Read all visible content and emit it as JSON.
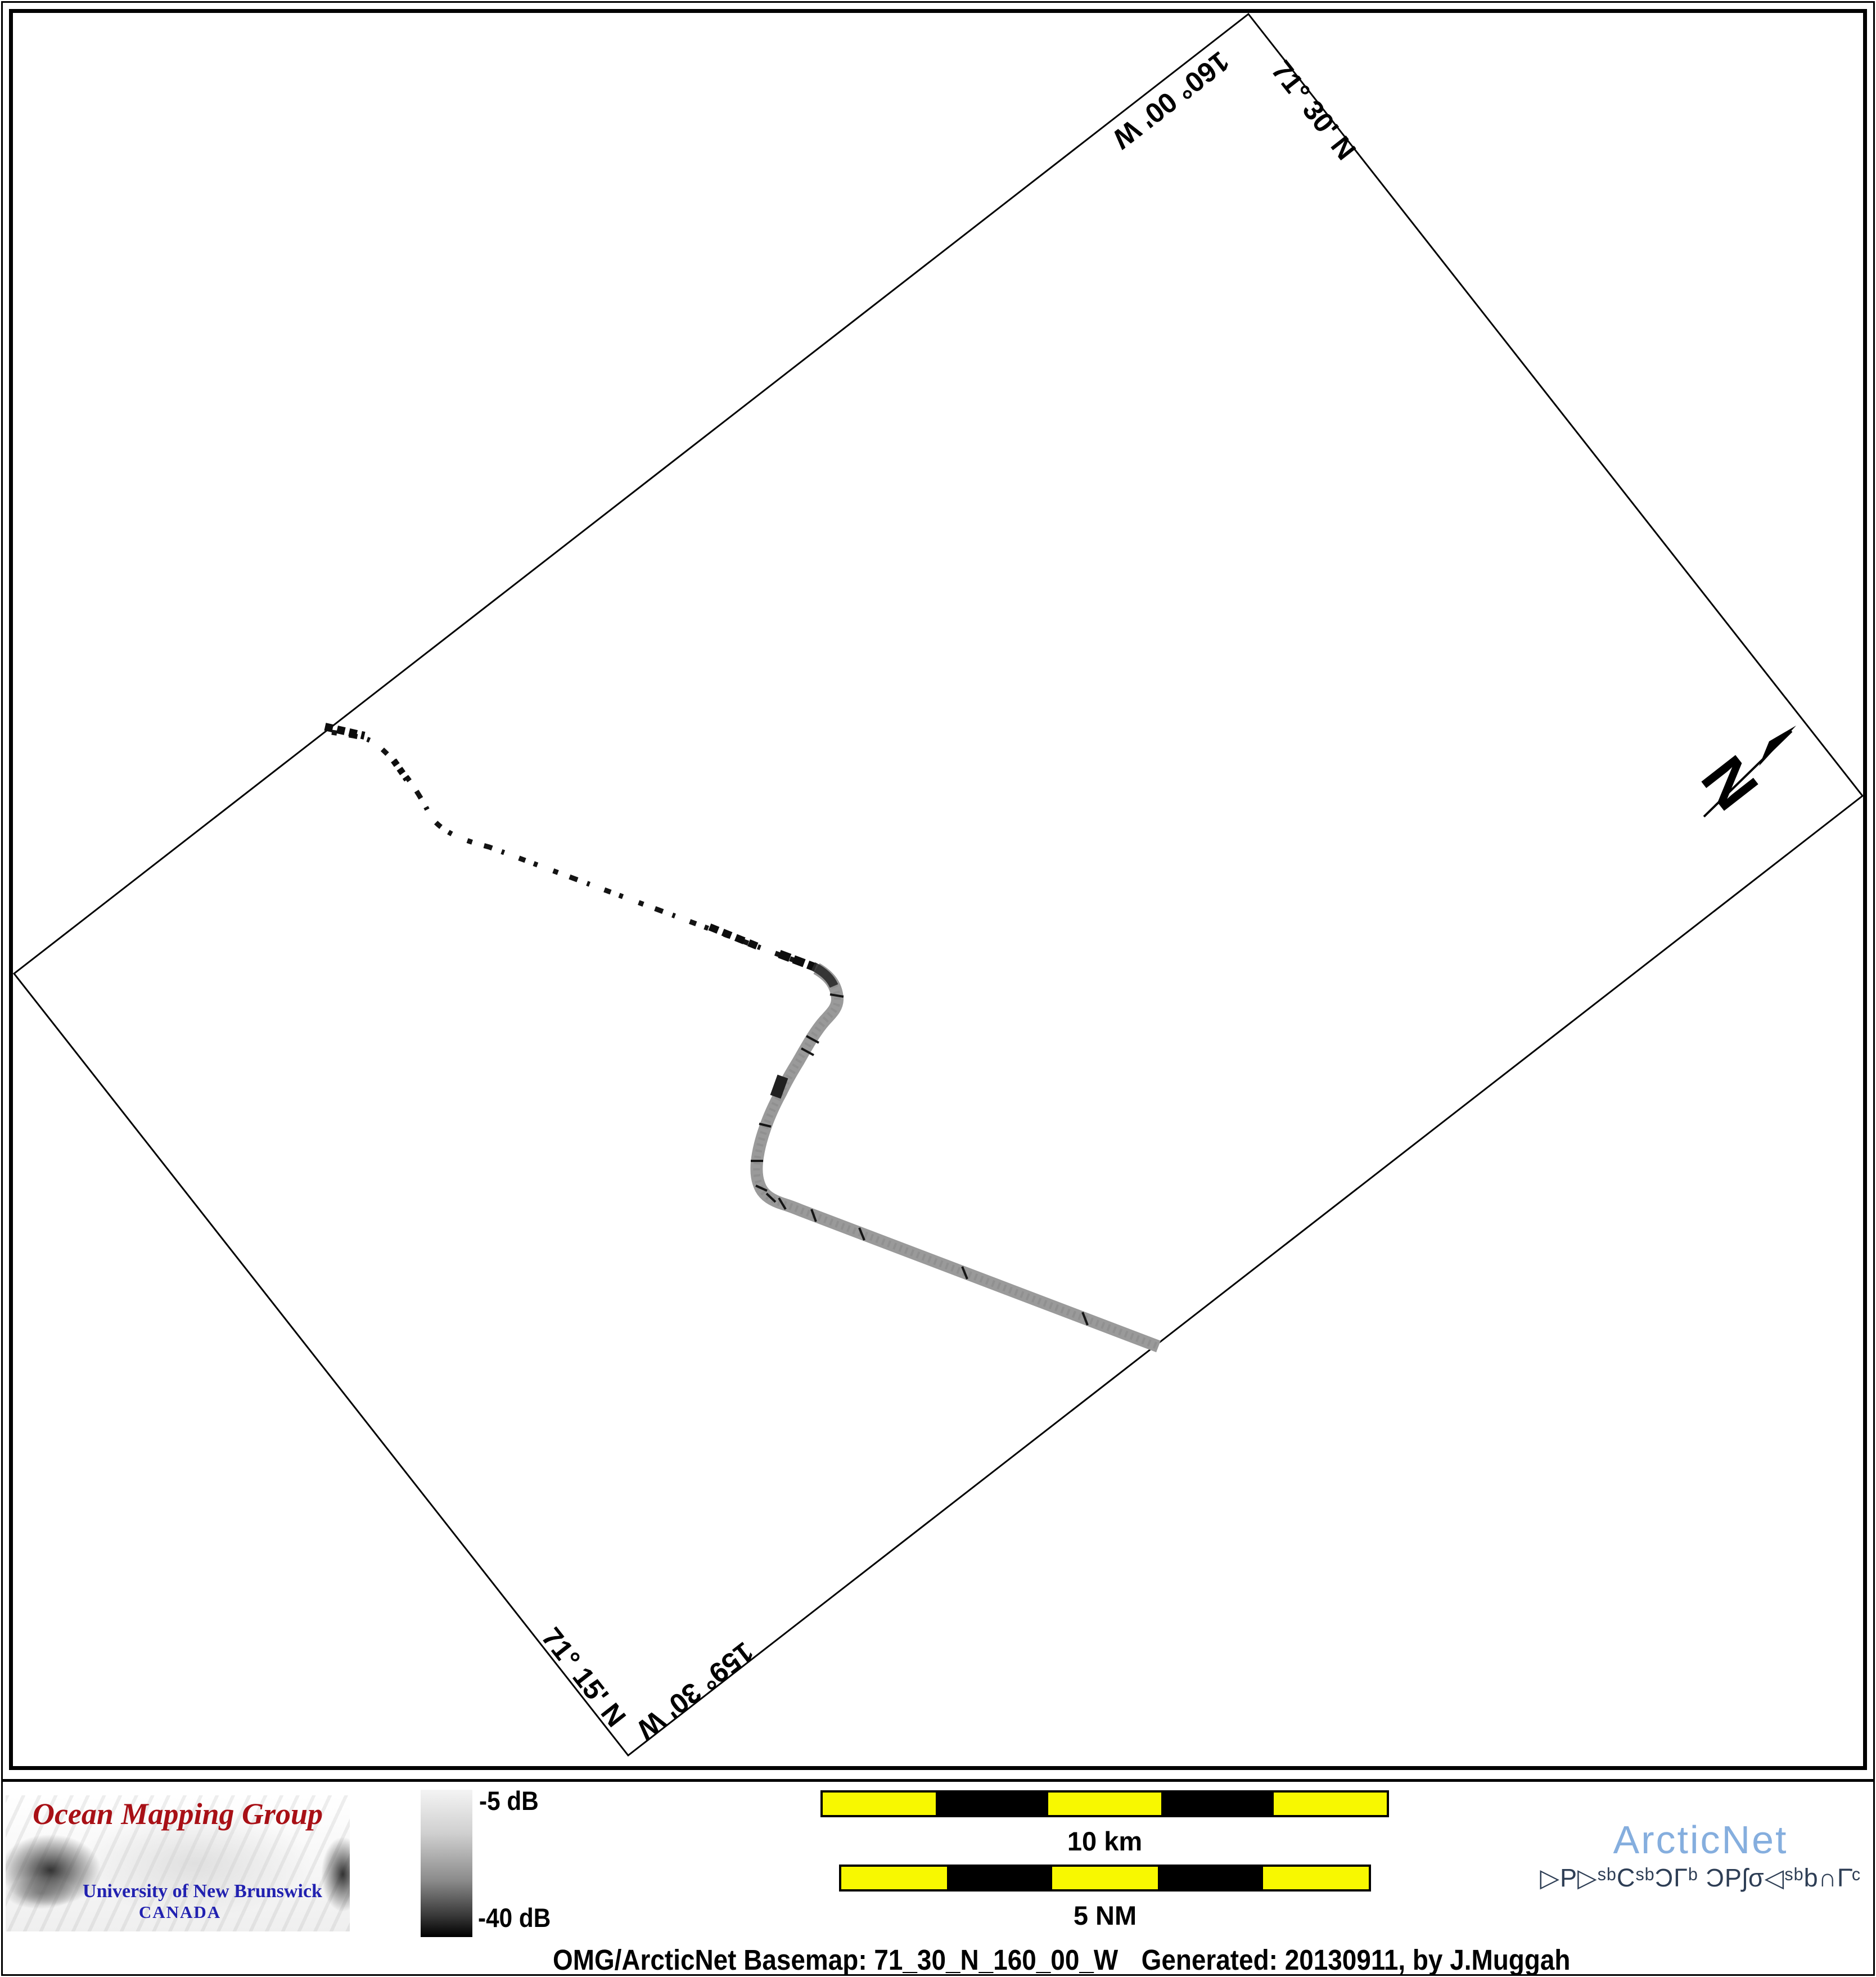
{
  "map": {
    "corner_labels": {
      "top_left_edge": "160° 00' W",
      "top_right_edge": "71° 30' N",
      "bottom_left_edge": "71° 15' N",
      "bottom_right_edge": "159° 30' W"
    },
    "north_arrow_label": "N"
  },
  "footer": {
    "omg_logo": {
      "title": "Ocean Mapping Group",
      "university": "University of New Brunswick",
      "country": "CANADA"
    },
    "colorbar": {
      "top_label": "-5 dB",
      "bottom_label": "-40 dB"
    },
    "scalebars": [
      {
        "label": "10 km"
      },
      {
        "label": "5 NM"
      }
    ],
    "caption": {
      "basemap": "OMG/ArcticNet Basemap: 71_30_N_160_00_W",
      "generated": "Generated: 20130911, by J.Muggah"
    },
    "arcticnet_logo": {
      "name": "ArcticNet",
      "inuktitut": "▷P▷ˢᵇCˢᵇƆΓᵇ ƆPʃσ◁ˢᵇb∩Γ̇ᶜ"
    }
  },
  "colors": {
    "scalebar_yellow": "#f8f800",
    "omg_red": "#a81016",
    "unb_blue": "#2121b0",
    "arcticnet_blue": "#85aede",
    "arcticnet_navy": "#2e3e55",
    "track_gray": "#9a9a9a"
  }
}
